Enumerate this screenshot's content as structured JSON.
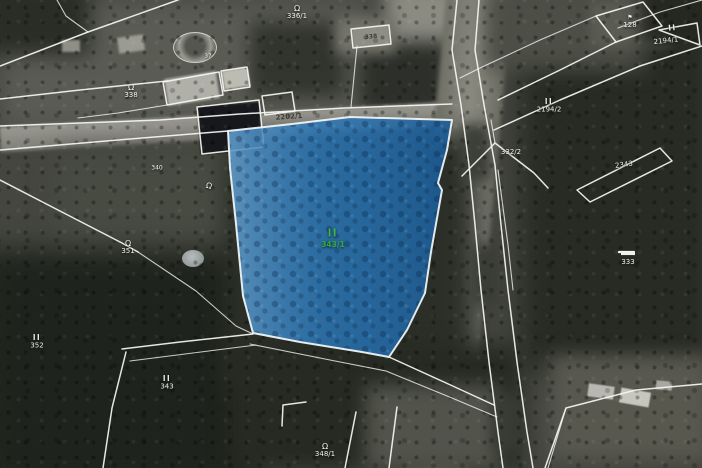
{
  "map": {
    "view_type": "cadastral-parcels-over-aerial",
    "line_color": "#f5f5f2",
    "selected_parcel": {
      "number": "343/1",
      "landuse_symbol": "II",
      "fill_color": "#2271b5",
      "outline_color": "#eef4f6",
      "symbol_color": "#3fbd41",
      "number_color": "#35aa39"
    },
    "labels": [
      {
        "id": "336-1",
        "text": "336/1",
        "symbol": "omega"
      },
      {
        "id": "338",
        "text": "338",
        "symbol": "omega"
      },
      {
        "id": "37",
        "text": "37",
        "symbol": null
      },
      {
        "id": "house-338",
        "text": "338",
        "symbol": null
      },
      {
        "id": "2202-1",
        "text": "2202/1",
        "symbol": null
      },
      {
        "id": "128",
        "text": "128",
        "symbol": "flag"
      },
      {
        "id": "2194-1",
        "text": "2194/1",
        "symbol": "II"
      },
      {
        "id": "2194-2",
        "text": "2194/2",
        "symbol": "II"
      },
      {
        "id": "332-2",
        "text": "332/2",
        "symbol": null
      },
      {
        "id": "2343",
        "text": "2343",
        "symbol": null
      },
      {
        "id": "333",
        "text": "333",
        "symbol": "dash"
      },
      {
        "id": "340",
        "text": "340",
        "symbol": null
      },
      {
        "id": "garden-symbol-1",
        "text": "",
        "symbol": "omega"
      },
      {
        "id": "351",
        "text": "351",
        "symbol": "omega"
      },
      {
        "id": "352",
        "text": "352",
        "symbol": "II"
      },
      {
        "id": "343",
        "text": "343",
        "symbol": "II"
      },
      {
        "id": "348-1",
        "text": "348/1",
        "symbol": "omega"
      },
      {
        "id": "343-1",
        "text": "343/1",
        "symbol": "II",
        "selected": true
      }
    ]
  }
}
